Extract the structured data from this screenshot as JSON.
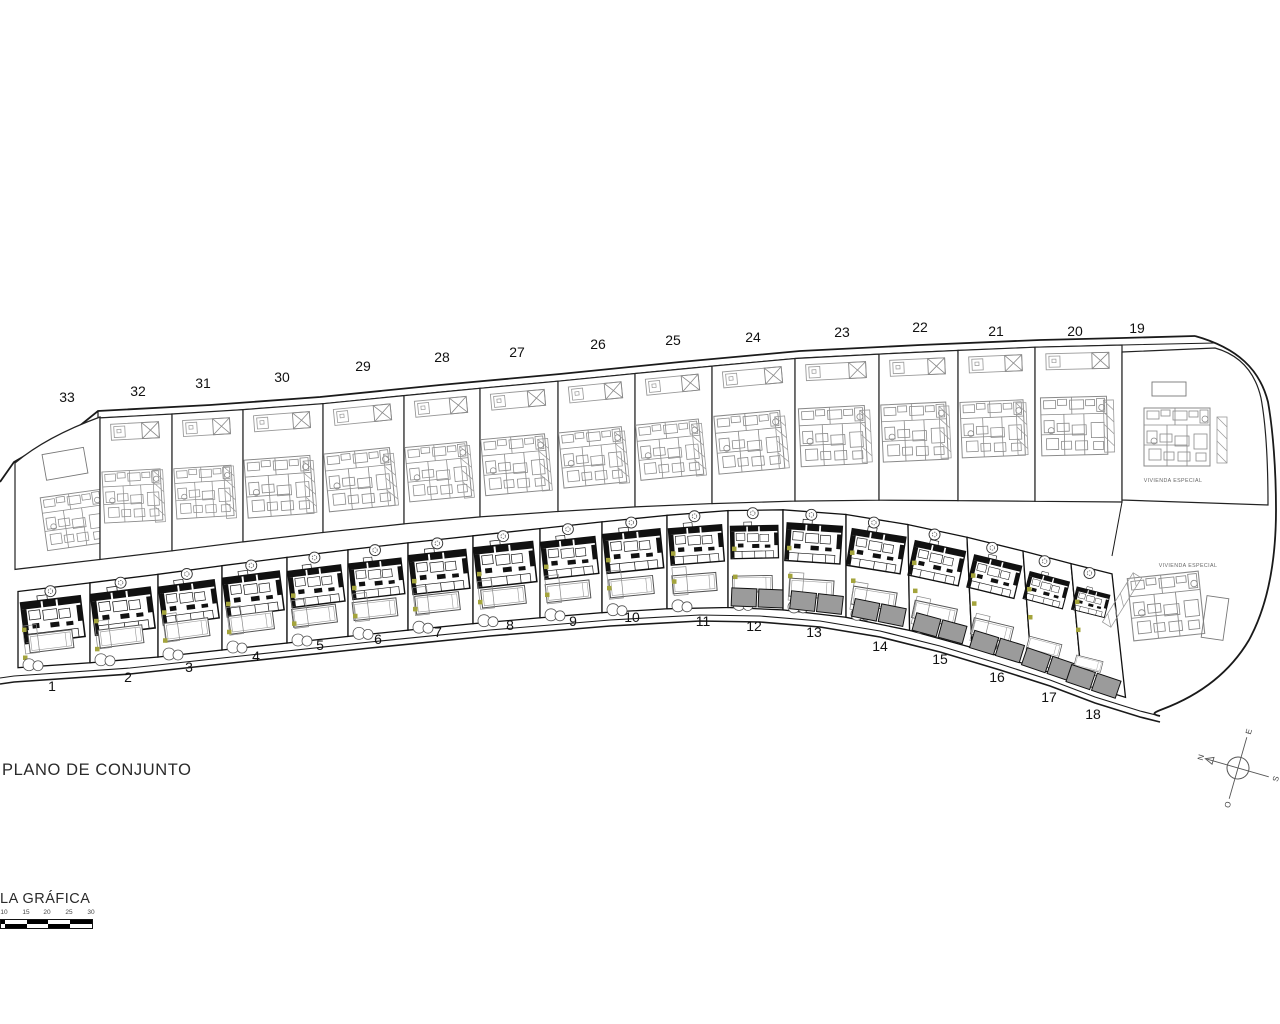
{
  "title": "PLANO DE CONJUNTO",
  "scale_bar": {
    "label": "LA GRÁFICA",
    "ticks": [
      "10",
      "15",
      "20",
      "25",
      "30"
    ]
  },
  "compass": {
    "north": "N",
    "east": "E",
    "south": "S",
    "west": "O"
  },
  "special_area_labels": [
    {
      "text": "VIVIENDA ESPECIAL",
      "x": 1173,
      "y": 482
    },
    {
      "text": "VIVIENDA ESPECIAL",
      "x": 1188,
      "y": 567
    }
  ],
  "colors": {
    "line": "#1a1a1a",
    "light_plan": "#8a8a8a",
    "dark_plan": "#111111",
    "pad_fill": "#9b9b9b",
    "shrub_green": "#a4a43c",
    "background": "#ffffff"
  },
  "plots_top": [
    {
      "number": "33",
      "label_x": 67,
      "label_y": 402
    },
    {
      "number": "32",
      "label_x": 138,
      "label_y": 396
    },
    {
      "number": "31",
      "label_x": 203,
      "label_y": 388
    },
    {
      "number": "30",
      "label_x": 282,
      "label_y": 382
    },
    {
      "number": "29",
      "label_x": 363,
      "label_y": 371
    },
    {
      "number": "28",
      "label_x": 442,
      "label_y": 362
    },
    {
      "number": "27",
      "label_x": 517,
      "label_y": 357
    },
    {
      "number": "26",
      "label_x": 598,
      "label_y": 349
    },
    {
      "number": "25",
      "label_x": 673,
      "label_y": 345
    },
    {
      "number": "24",
      "label_x": 753,
      "label_y": 342
    },
    {
      "number": "23",
      "label_x": 842,
      "label_y": 337
    },
    {
      "number": "22",
      "label_x": 920,
      "label_y": 332
    },
    {
      "number": "21",
      "label_x": 996,
      "label_y": 336
    },
    {
      "number": "20",
      "label_x": 1075,
      "label_y": 336
    },
    {
      "number": "19",
      "label_x": 1137,
      "label_y": 333
    }
  ],
  "plots_bottom": [
    {
      "number": "1",
      "label_x": 52,
      "label_y": 691
    },
    {
      "number": "2",
      "label_x": 128,
      "label_y": 682
    },
    {
      "number": "3",
      "label_x": 189,
      "label_y": 672
    },
    {
      "number": "4",
      "label_x": 256,
      "label_y": 661
    },
    {
      "number": "5",
      "label_x": 320,
      "label_y": 650
    },
    {
      "number": "6",
      "label_x": 378,
      "label_y": 644
    },
    {
      "number": "7",
      "label_x": 438,
      "label_y": 637
    },
    {
      "number": "8",
      "label_x": 510,
      "label_y": 630
    },
    {
      "number": "9",
      "label_x": 573,
      "label_y": 626
    },
    {
      "number": "10",
      "label_x": 632,
      "label_y": 622
    },
    {
      "number": "11",
      "label_x": 703,
      "label_y": 626
    },
    {
      "number": "12",
      "label_x": 754,
      "label_y": 631
    },
    {
      "number": "13",
      "label_x": 814,
      "label_y": 637
    },
    {
      "number": "14",
      "label_x": 880,
      "label_y": 651
    },
    {
      "number": "15",
      "label_x": 940,
      "label_y": 664
    },
    {
      "number": "16",
      "label_x": 997,
      "label_y": 682
    },
    {
      "number": "17",
      "label_x": 1049,
      "label_y": 702
    },
    {
      "number": "18",
      "label_x": 1093,
      "label_y": 719
    }
  ]
}
